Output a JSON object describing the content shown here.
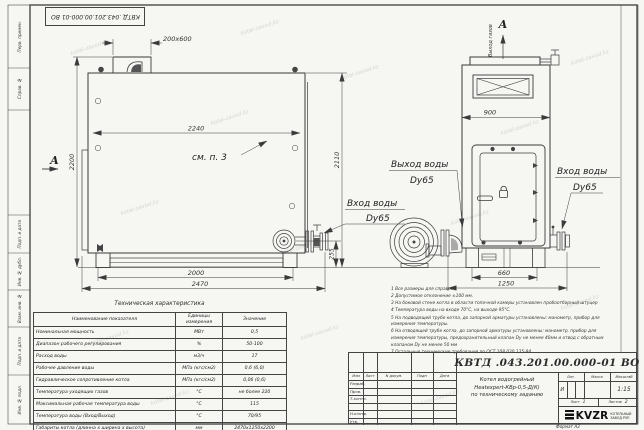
{
  "sheet": {
    "doc_number": "КВТД .043.201.00.000-01 ВО",
    "format_label": "Формат  А3",
    "watermark": "kotel-zavod.kz"
  },
  "margin_labels": {
    "perv_primen": "Перв. примен.",
    "sprav_no": "Справ. №",
    "podp_data1": "Подп. и дата",
    "inv_dubl": "Инв. № дубл.",
    "vzam_inv": "Взам. инв. №",
    "podp_data2": "Подп. и дата",
    "inv_podl": "Инв. № подл."
  },
  "drawing": {
    "section_letter_left": "А",
    "section_letter_top": "А",
    "gas_out_label": "Выход газов",
    "see_note": "см. п. 3",
    "dims": {
      "flue": "200x600",
      "width_inner": "2240",
      "height_left": "2200",
      "height_mid": "2110",
      "base_inner": "2000",
      "length_total": "2470",
      "flange_height": "255",
      "front_width": "900",
      "front_base": "660",
      "front_total": "1250"
    },
    "labels": {
      "water_out": "Выход воды",
      "water_out_dn": "Dy65",
      "water_in_mid": "Вход воды",
      "water_in_mid_dn": "Dy65",
      "water_in_right": "Вход воды",
      "water_in_right_dn": "Dy65"
    }
  },
  "notes": {
    "lines": [
      "1  Все размеры для справок",
      "2  Допустимое отклонение ±100 мм.",
      "3  На боковой стене котла в области топочной камеры установлен пробоотборный штуцер",
      "4  Температура воды на входе 70°С, на выходе 95°С.",
      "5  На подводящей трубе котла, до запорной арматуры установлены: манометр, прибор для измерения температуры.",
      "6  На отводящей трубе котла, до запорной арматуры установлены: манометр, прибор для измерения температуры, предохранительный клапан Dу не менее 40мм и отвод с обратным клапаном Dу не менее 50 мм",
      "7  Остальные технические требования по ОСТ 108.030.135-84"
    ]
  },
  "tech_table": {
    "title": "Техническая характеристика",
    "headers": [
      "Наименование показателя",
      "Единицы измерения",
      "Значение"
    ],
    "rows": [
      [
        "Номинальная мощность",
        "МВт",
        "0,5"
      ],
      [
        "Диапазон рабочего регулирования",
        "%",
        "50-100"
      ],
      [
        "Расход воды",
        "м3/ч",
        "17"
      ],
      [
        "Рабочее давление воды",
        "МПа (кгс/см2)",
        "0,6 (6,0)"
      ],
      [
        "Гидравлическое сопротивление котла",
        "МПа (кгс/см2)",
        "0,06 (0,6)"
      ],
      [
        "Температура уходящих газов",
        "°С",
        "не более 220"
      ],
      [
        "Максимальная рабочая температура воды",
        "°С",
        "115"
      ],
      [
        "Температура воды (Вход/Выход)",
        "°С",
        "70/95"
      ],
      [
        "Габариты котла (длинна х ширина х высота)",
        "мм",
        "2470х1250х2200"
      ]
    ]
  },
  "title_block": {
    "doc_number": "КВТД .043.201.00.000-01 ВО",
    "header_cells": [
      "Изм",
      "Лист",
      "N докум.",
      "Подп",
      "Дата"
    ],
    "row_labels": [
      "Разраб.",
      "Пров.",
      "Т.контр.",
      "Н.контр.",
      "Утв."
    ],
    "product_name_1": "Котел водогрейный",
    "product_name_2": "Heatexpert-КВр-0,5-Д(К)",
    "product_name_3": "по техническому заданию",
    "lit_header": "Лит.",
    "lit_value": "И",
    "mass_header": "Масса",
    "scale_header": "Масштаб",
    "scale_value": "1:15",
    "sheet_label": "Лист",
    "sheet_value": "1",
    "sheets_label": "Листов",
    "sheets_value": "2",
    "company_logo": "KVZR",
    "company_name_1": "КОТЕЛЬНЫЙ",
    "company_name_2": "ЗАВОД РЭП"
  }
}
